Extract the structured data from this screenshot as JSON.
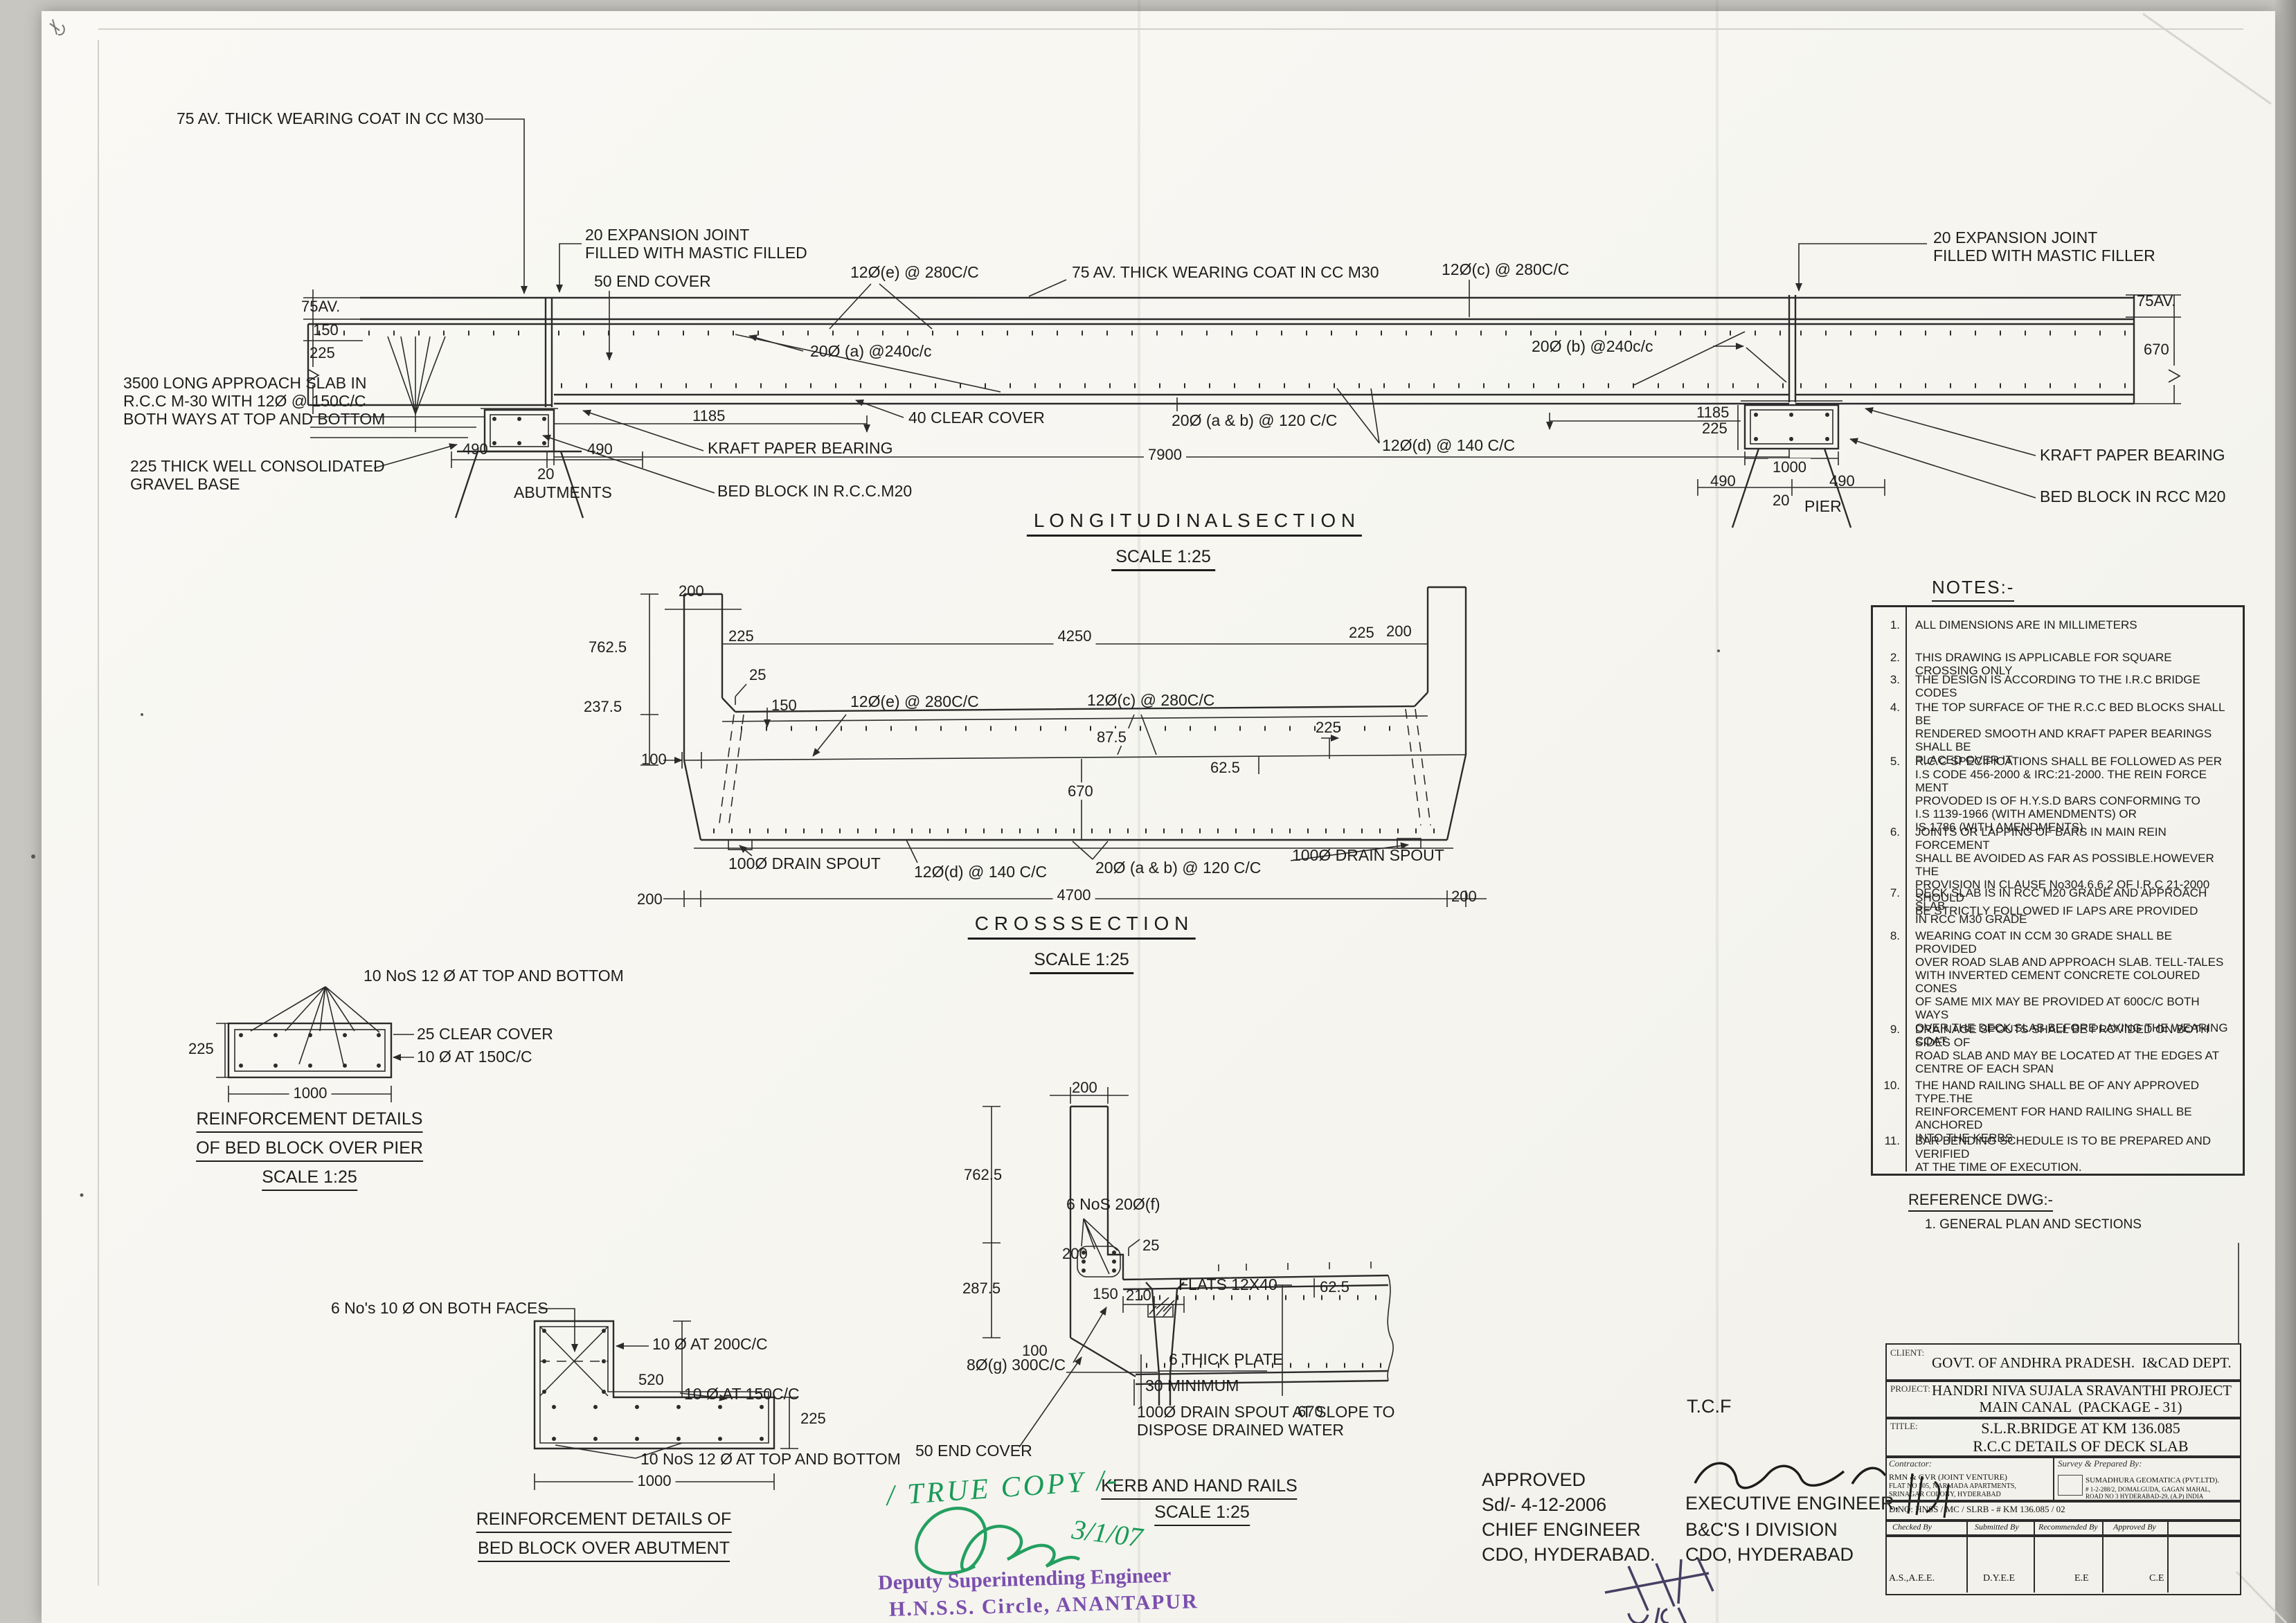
{
  "longitudinal": {
    "title": "L O N G I T U D I N A L   S E C T I O N",
    "scale": "SCALE 1:25",
    "wearing_coat_left": "75 AV. THICK WEARING COAT IN CC M30",
    "exp_joint_left": "20 EXPANSION JOINT\nFILLED WITH MASTIC FILLED",
    "end_cover": "50 END COVER",
    "bar_e": "12Ø(e) @ 280C/C",
    "wearing_coat_center": "75 AV. THICK WEARING COAT  IN CC M30",
    "bar_c": "12Ø(c) @ 280C/C",
    "exp_joint_right": "20 EXPANSION JOINT\nFILLED WITH MASTIC FILLER",
    "bar_a": "20Ø (a) @240c/c",
    "bar_b": "20Ø (b) @240c/c",
    "dim_75av_l": "75AV.",
    "dim_150_l": "150",
    "dim_225_l": "225",
    "approach_slab": "3500 LONG APPROACH SLAB IN\nR.C.C M-30 WITH 12Ø @ 150C/C\nBOTH WAYS AT TOP AND BOTTOM",
    "gravel_base": "225 THICK WELL CONSOLIDATED\nGRAVEL BASE",
    "dim_1185_l": "1185",
    "clear_cover": "40 CLEAR COVER",
    "kraft_l": "KRAFT PAPER BEARING",
    "bed_block_l": "BED BLOCK IN R.C.C.M20",
    "dim_490a_l": "490",
    "dim_490b_l": "490",
    "dim_20_l": "20",
    "abutments": "ABUTMENTS",
    "bar_ab": "20Ø (a & b) @ 120 C/C",
    "bar_d": "12Ø(d) @ 140 C/C",
    "dim_7900": "7900",
    "dim_1185_r": "1185",
    "dim_225_r": "225",
    "dim_75av_r": "75AV.",
    "dim_670_r": "670",
    "kraft_r": "KRAFT PAPER BEARING",
    "bed_block_r": "BED BLOCK IN RCC M20",
    "dim_1000_r": "1000",
    "dim_490a_r": "490",
    "dim_490b_r": "490",
    "dim_20_r": "20",
    "pier": "PIER"
  },
  "cross": {
    "title": "C R O S S   S E C T I O N",
    "scale": "SCALE 1:25",
    "dim_200_tl": "200",
    "dim_225_kl": "225",
    "dim_4250": "4250",
    "dim_225_kr": "225",
    "dim_200_tr": "200",
    "dim_762": "762.5",
    "dim_237": "237.5",
    "dim_25": "25",
    "dim_150": "150",
    "bar_e": "12Ø(e) @ 280C/C",
    "bar_c": "12Ø(c) @ 280C/C",
    "dim_87": "87.5",
    "dim_225_in": "225",
    "dim_62": "62.5",
    "dim_100": "100",
    "dim_670": "670",
    "drain_l": "100Ø DRAIN SPOUT",
    "drain_r": "100Ø DRAIN SPOUT",
    "bar_d": "12Ø(d) @ 140 C/C",
    "bar_ab": "20Ø (a & b) @ 120 C/C",
    "dim_200_bl": "200",
    "dim_4700": "4700",
    "dim_200_br": "200"
  },
  "pier_detail": {
    "bars_label": "10 NoS 12 Ø AT TOP AND BOTTOM",
    "clear_cover": "25 CLEAR COVER",
    "stirrups": "10 Ø AT 150C/C",
    "dim_225": "225",
    "dim_1000": "1000",
    "title1": "REINFORCEMENT DETAILS",
    "title2": "OF BED BLOCK OVER PIER",
    "scale": "SCALE 1:25"
  },
  "abutment_detail": {
    "faces_label": "6 No's 10 Ø ON BOTH FACES",
    "bar_200": "10 Ø AT 200C/C",
    "dim_520": "520",
    "bar_150": "10 Ø AT 150C/C",
    "dim_225": "225",
    "bars_label": "10 NoS 12 Ø AT TOP AND BOTTOM",
    "dim_1000": "1000",
    "title1": "REINFORCEMENT DETAILS OF",
    "title2": "BED BLOCK OVER ABUTMENT"
  },
  "kerb_detail": {
    "dim_200_top": "200",
    "dim_762": "762.5",
    "bars_f": "6 NoS 20Ø(f)",
    "dim_200_loop": "200",
    "dim_25": "25",
    "dim_287": "287.5",
    "dim_150": "150",
    "dim_210": "210",
    "flats": "FLATS 12X40",
    "dim_62": "62.5",
    "dim_100": "100",
    "plate": "6 THICK PLATE",
    "dim_670": "670",
    "end_cover": "50 END COVER",
    "bar_g": "8Ø(g) 300C/C",
    "min_30": "30 MINIMUM",
    "drain": "100Ø DRAIN SPOUT AT SLOPE TO\nDISPOSE DRAINED WATER",
    "title": "KERB AND HAND RAILS",
    "scale": "SCALE 1:25"
  },
  "notes": {
    "title": "NOTES:-",
    "items": [
      {
        "num": "1.",
        "text": "ALL DIMENSIONS ARE IN MILLIMETERS"
      },
      {
        "num": "2.",
        "text": "THIS DRAWING IS APPLICABLE FOR SQUARE CROSSING ONLY"
      },
      {
        "num": "3.",
        "text": "THE DESIGN IS ACCORDING TO THE I.R.C BRIDGE CODES"
      },
      {
        "num": "4.",
        "text": "THE TOP SURFACE OF THE R.C.C BED BLOCKS SHALL BE\nRENDERED SMOOTH AND KRAFT PAPER BEARINGS SHALL BE\nPLACED OVER IT"
      },
      {
        "num": "5.",
        "text": "R.C.C SPECIFICATIONS SHALL BE FOLLOWED AS PER\nI.S CODE 456-2000 & IRC:21-2000. THE REIN FORCE MENT\nPROVODED IS OF H.Y.S.D BARS CONFORMING TO\nI.S 1139-1966 (WITH AMENDMENTS) OR\nIS 1786  (WITH AMENDMENTS)"
      },
      {
        "num": "6.",
        "text": "JOINTS OR LAPPING OF BARS IN MAIN REIN FORCEMENT\nSHALL BE AVOIDED AS FAR AS POSSIBLE.HOWEVER THE\nPROVISION IN CLAUSE No304.6.6.2 OF I.R.C 21-2000 SHOULD\nBE STRICTLY FOLLOWED IF LAPS ARE PROVIDED"
      },
      {
        "num": "7.",
        "text": "DECK SLAB IS IN RCC M20 GRADE AND APPROACH SLAB\nIN RCC M30 GRADE"
      },
      {
        "num": "8.",
        "text": "WEARING COAT IN CCM 30 GRADE SHALL BE PROVIDED\nOVER ROAD SLAB AND APPROACH SLAB. TELL-TALES\nWITH INVERTED CEMENT CONCRETE COLOURED CONES\nOF SAME MIX MAY BE PROVIDED AT 600C/C BOTH WAYS\nOVER THE DECK SLAB BEFORE LAYING THE WEARING COAT"
      },
      {
        "num": "9.",
        "text": "DRAINAGE SPOUTS SHALL BE PROVIDED ON BOTH SIDES OF\nROAD SLAB AND MAY BE LOCATED AT THE EDGES AT\nCENTRE OF EACH SPAN"
      },
      {
        "num": "10.",
        "text": "THE HAND RAILING SHALL BE OF ANY APPROVED TYPE.THE\nREINFORCEMENT FOR HAND RAILING SHALL BE ANCHORED\nINTO THE KERBS"
      },
      {
        "num": "11.",
        "text": "BAR BENDING SCHEDULE IS TO BE PREPARED AND VERIFIED\nAT THE TIME OF EXECUTION."
      }
    ]
  },
  "reference": {
    "title": "REFERENCE DWG:-",
    "item": "1. GENERAL PLAN AND SECTIONS"
  },
  "stamps": {
    "true_copy": "/ TRUE COPY /-",
    "green_date": "3/1/07",
    "dse1": "Deputy Superintending Engineer",
    "dse2": "H.N.S.S. Circle, ANANTAPUR",
    "tcf": "T.C.F",
    "approved1": "APPROVED",
    "approved2": "Sd/- 4-12-2006",
    "approved3": "CHIEF ENGINEER",
    "approved4": "CDO, HYDERABAD.",
    "exec1": "EXECUTIVE ENGINEER,",
    "exec2": "B&C'S  I DIVISION",
    "exec3": "CDO, HYDERABAD"
  },
  "titleblock": {
    "client_label": "CLIENT:",
    "client": "GOVT. OF ANDHRA PRADESH.  I&CAD DEPT.",
    "project_label": "PROJECT:",
    "project1": "HANDRI NIVA SUJALA SRAVANTHI PROJECT",
    "project2": "MAIN CANAL  (PACKAGE - 31)",
    "title_label": "TITLE:",
    "title1": "S.L.R.BRIDGE AT KM 136.085",
    "title2": "R.C.C DETAILS OF DECK SLAB",
    "contractor_label": "Contractor:",
    "contractor1": "RMN & GVR (JOINT VENTURE)",
    "contractor2": "FLAT NO 505, NARMADA APARTMENTS,",
    "contractor3": "SRINAGAR COLONY, HYDERABAD",
    "survey_label": "Survey & Prepared By:",
    "survey1": "SUMADHURA GEOMATICA (PVT.LTD).",
    "survey2": "# 1-2-288/2, DOMALGUDA, GAGAN MAHAL,",
    "survey3": "ROAD NO 3 HYDERABAD-29, (A.P) INDIA",
    "dno": "D.NO: HNSS / MC / SLRB - # KM 136.085 / 02",
    "sig_headers": [
      "Checked By",
      "Submitted By",
      "Recommended By",
      "Approved By"
    ],
    "sig_values": [
      "A.S.,A.E.E.",
      "D.Y.E.E",
      "E.E",
      "C.E"
    ]
  }
}
